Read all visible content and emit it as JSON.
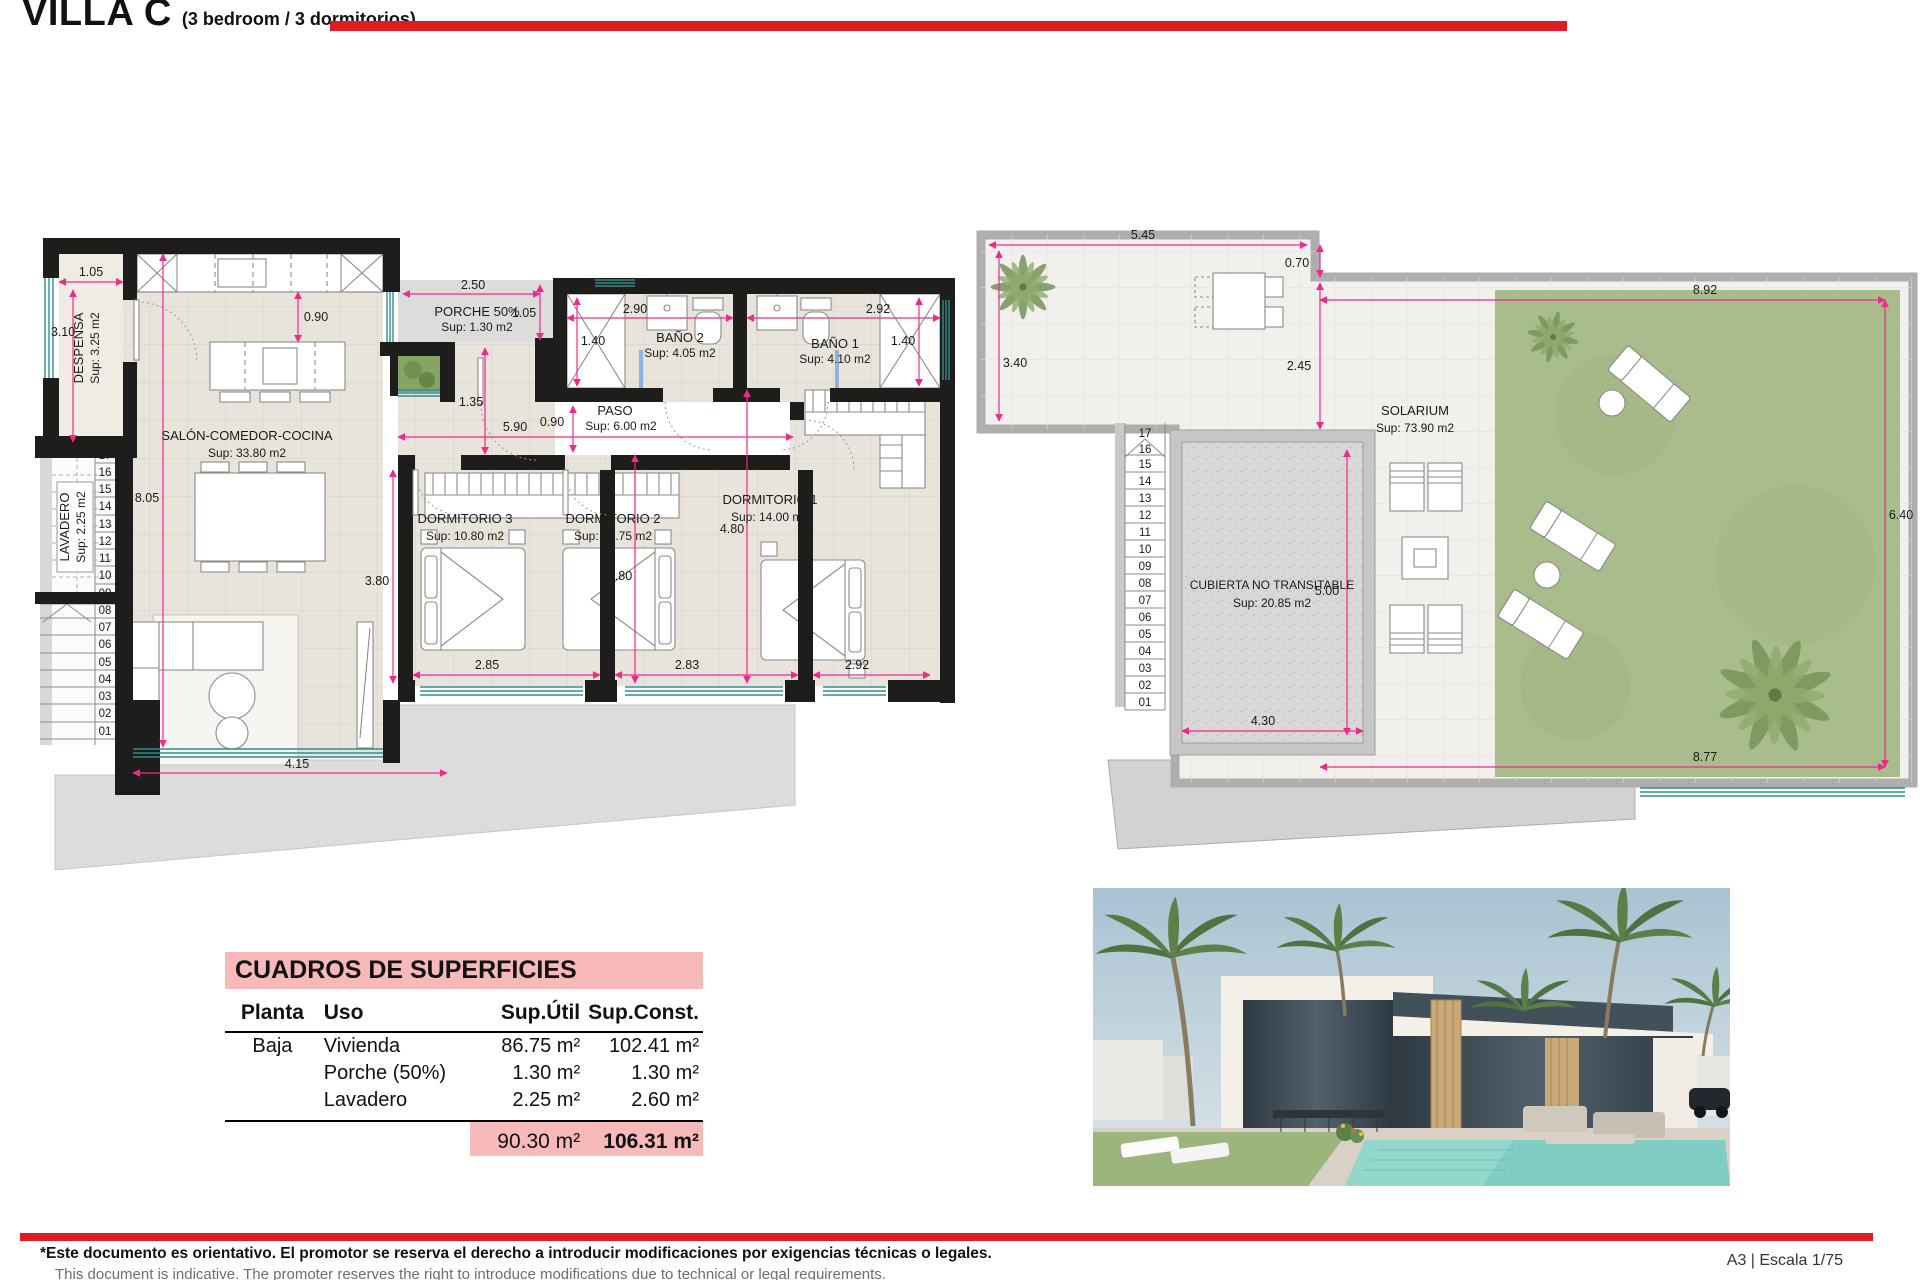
{
  "header": {
    "title": "VILLA C",
    "subtitle": "(3 bedroom / 3 dormitorios)"
  },
  "colors": {
    "accent_red": "#e11b22",
    "dimension_pink": "#ee2a8c",
    "table_pink": "#f7b9ba",
    "wall_black": "#1d1d1b",
    "window_teal": "#2e8f8f",
    "grass_green": "#a9bc8b",
    "floor_beige": "#e8e3db",
    "terrace_gray": "#dcdcda"
  },
  "floor_plan": {
    "rooms": {
      "despensa": {
        "label": "DESPENSA",
        "sup": "Sup: 3.25 m2"
      },
      "lavadero": {
        "label": "LAVADERO",
        "sup": "Sup: 2.25 m2"
      },
      "salon": {
        "label": "SALÓN-COMEDOR-COCINA",
        "sup": "Sup: 33.80 m2"
      },
      "porche": {
        "label": "PORCHE 50%",
        "sup": "Sup: 1.30 m2"
      },
      "bano2": {
        "label": "BAÑO 2",
        "sup": "Sup: 4.05 m2"
      },
      "bano1": {
        "label": "BAÑO 1",
        "sup": "Sup: 4.10 m2"
      },
      "paso": {
        "label": "PASO",
        "sup": "Sup: 6.00 m2"
      },
      "dorm3": {
        "label": "DORMITORIO 3",
        "sup": "Sup: 10.80 m2"
      },
      "dorm2": {
        "label": "DORMITORIO 2",
        "sup": "Sup: 10.75 m2"
      },
      "dorm1": {
        "label": "DORMITORIO 1",
        "sup": "Sup: 14.00 m2"
      }
    },
    "dims": {
      "despensa_w": "1.05",
      "despensa_h": "3.10",
      "kitchen_aisle": "0.90",
      "porche_w": "2.50",
      "porche_h": "1.05",
      "bano2_h": "1.40",
      "bano2_w": "2.90",
      "bano1_w": "2.92",
      "bano1_h": "1.40",
      "hall_jog": "1.35",
      "paso_w": "0.90",
      "paso_len": "5.90",
      "salon_h": "8.05",
      "dorm3_h": "3.80",
      "dorm2_h": "3.80",
      "dorm1_h": "4.80",
      "dorm3_w": "2.85",
      "dorm2_w": "2.83",
      "dorm1_w": "2.92",
      "salon_w": "4.15"
    },
    "stairs": [
      "17",
      "16",
      "15",
      "14",
      "13",
      "12",
      "11",
      "10",
      "09",
      "08",
      "07",
      "06",
      "05",
      "04",
      "03",
      "02",
      "01"
    ]
  },
  "roof_plan": {
    "rooms": {
      "solarium": {
        "label": "SOLARIUM",
        "sup": "Sup: 73.90 m2"
      },
      "cubierta": {
        "label": "CUBIERTA NO TRANSITABLE",
        "sup": "Sup: 20.85 m2"
      }
    },
    "dims": {
      "terrace_w": "5.45",
      "roof_step": "0.70",
      "terrace_h": "3.40",
      "terrace_side": "2.45",
      "grass_w": "8.92",
      "grass_h": "6.40",
      "grass_bottom_w": "8.77",
      "cubierta_h": "5.00",
      "cubierta_w": "4.30"
    },
    "stairs": [
      "17",
      "16",
      "15",
      "14",
      "13",
      "12",
      "11",
      "10",
      "09",
      "08",
      "07",
      "06",
      "05",
      "04",
      "03",
      "02",
      "01"
    ]
  },
  "areas_table": {
    "title": "CUADROS DE SUPERFICIES",
    "headers": [
      "Planta",
      "Uso",
      "Sup.Útil",
      "Sup.Const."
    ],
    "rows": [
      {
        "planta": "Baja",
        "uso": "Vivienda",
        "util": "86.75 m²",
        "const": "102.41 m²"
      },
      {
        "planta": "",
        "uso": "Porche (50%)",
        "util": "1.30 m²",
        "const": "1.30 m²"
      },
      {
        "planta": "",
        "uso": "Lavadero",
        "util": "2.25 m²",
        "const": "2.60 m²"
      }
    ],
    "total": {
      "util": "90.30 m²",
      "const": "106.31 m²"
    }
  },
  "footer": {
    "disclaimer_es": "*Este documento es orientativo. El promotor se reserva el derecho a introducir modificaciones por exigencias técnicas o legales.",
    "disclaimer_en": "This document is indicative. The promoter reserves the right to introduce modifications due to technical or legal requirements.",
    "sheet_info": "A3 | Escala 1/75"
  }
}
